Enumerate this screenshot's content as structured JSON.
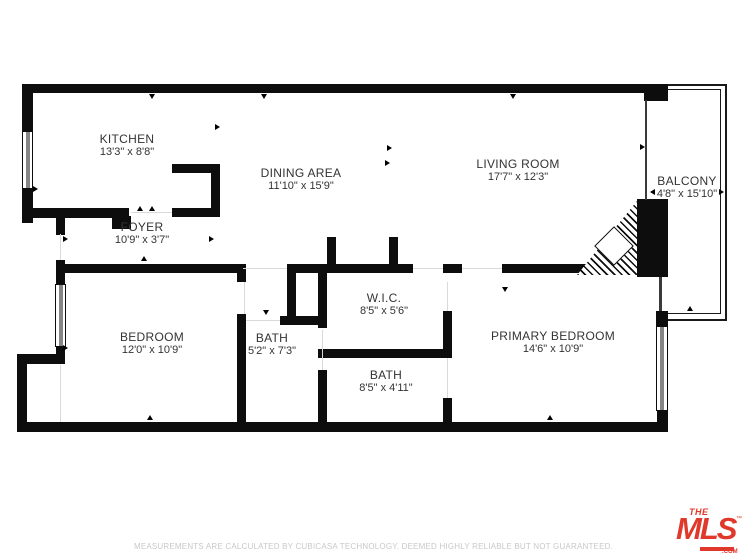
{
  "floor_plan": {
    "rooms": [
      {
        "name": "KITCHEN",
        "dims": "13'3\" x 8'8\""
      },
      {
        "name": "DINING AREA",
        "dims": "11'10\" x 15'9\""
      },
      {
        "name": "LIVING ROOM",
        "dims": "17'7\" x 12'3\""
      },
      {
        "name": "BALCONY",
        "dims": "4'8\" x 15'10\""
      },
      {
        "name": "FOYER",
        "dims": "10'9\" x 3'7\""
      },
      {
        "name": "BEDROOM",
        "dims": "12'0\" x 10'9\""
      },
      {
        "name": "BATH",
        "dims": "5'2\" x 7'3\""
      },
      {
        "name": "W.I.C.",
        "dims": "8'5\" x 5'6\""
      },
      {
        "name": "BATH",
        "dims": "8'5\" x 4'11\""
      },
      {
        "name": "PRIMARY BEDROOM",
        "dims": "14'6\" x 10'9\""
      }
    ],
    "footer": {
      "disclaimer": "MEASUREMENTS ARE CALCULATED BY CUBICASA TECHNOLOGY. DEEMED HIGHLY RELIABLE BUT NOT GUARANTEED."
    },
    "logo": {
      "the": "THE",
      "mls": "MLS",
      "com": ".COM",
      "tm": "™"
    },
    "colors": {
      "wall": "#0d0d0d",
      "label": "#333333",
      "disclaimer": "#c8c8c8",
      "logo_red": "#e0392c"
    }
  }
}
